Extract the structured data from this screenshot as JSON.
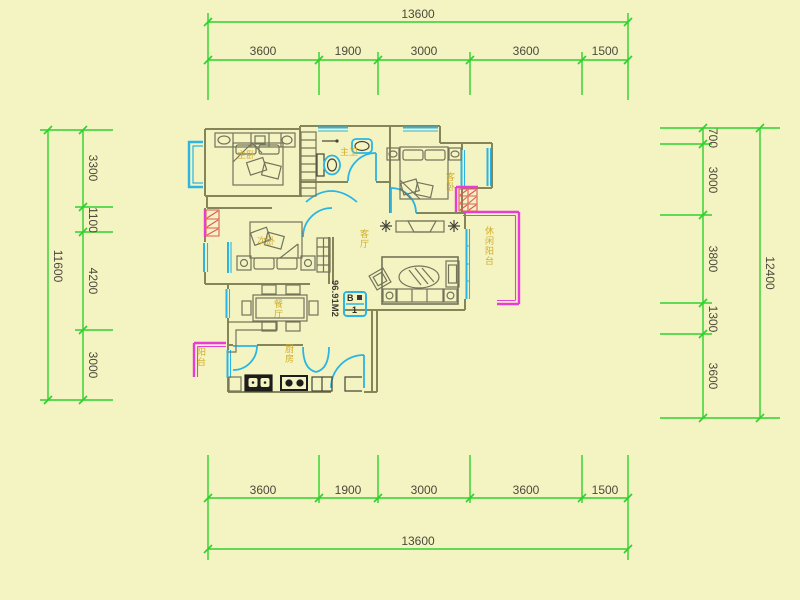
{
  "drawing": {
    "type": "apartment floor plan",
    "area_label": "96.91M2",
    "unit_badge": {
      "top": "B",
      "bottom": "1"
    }
  },
  "colors": {
    "background": "#f4f4c3",
    "dimension_green": "#2fd02f",
    "wall_olive": "#85855a",
    "window_cyan": "#2ab5e4",
    "railing_magenta": "#e83cd8",
    "hatch_red": "#e05858",
    "room_label_gold": "#d2ab28",
    "dim_text": "#4a4a3c"
  },
  "dimensions": {
    "top": {
      "total": "13600",
      "segments": [
        "3600",
        "1900",
        "3000",
        "3600",
        "1500"
      ]
    },
    "bottom": {
      "total": "13600",
      "segments": [
        "3600",
        "1900",
        "3000",
        "3600",
        "1500"
      ]
    },
    "left": {
      "total": "11600",
      "segments": [
        "3300",
        "1100",
        "4200",
        "3000"
      ]
    },
    "right": {
      "total": "12400",
      "segments": [
        "700",
        "3000",
        "3800",
        "1300",
        "3600"
      ]
    }
  },
  "rooms": {
    "master_bedroom": "主卧",
    "second_bedroom": "次卧",
    "guest_bedroom": "客卧",
    "bathroom": "主卫",
    "living_room": "客厅",
    "dining_room": "餐厅",
    "kitchen": "厨房",
    "balcony": "阳台",
    "leisure_balcony": "休闲阳台"
  }
}
